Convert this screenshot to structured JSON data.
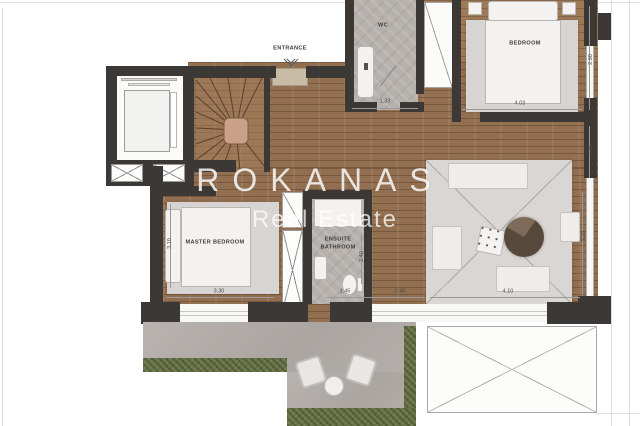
{
  "watermark": {
    "brand": "ROKANAS",
    "tagline": "Real Estate"
  },
  "rooms": {
    "entrance": "ENTRANCE",
    "wc": "WC",
    "bedroom": "BEDROOM",
    "master_bedroom": "MASTER BEDROOM",
    "ensuite_line1": "ENSUITE",
    "ensuite_line2": "BATHROOM"
  },
  "dimensions": {
    "wc_width": "1.33",
    "bedroom_width": "4.03",
    "bedroom_depth": "2.90",
    "hall_depth": "3.05",
    "hall_segment_a": "1.45",
    "hall_segment_b": "0.96",
    "master_depth": "3.10",
    "master_width": "3.30",
    "ensuite_depth": "2.40",
    "living_width": "4.10",
    "living_depth": "3.20"
  },
  "colors": {
    "wall": "#3b3835",
    "wood_floor": "#926f50",
    "tile": "#b6b1ad",
    "hedge_green": "#687447",
    "terrace_paving": "#b3adaa",
    "watermark_white": "#ffffff"
  }
}
